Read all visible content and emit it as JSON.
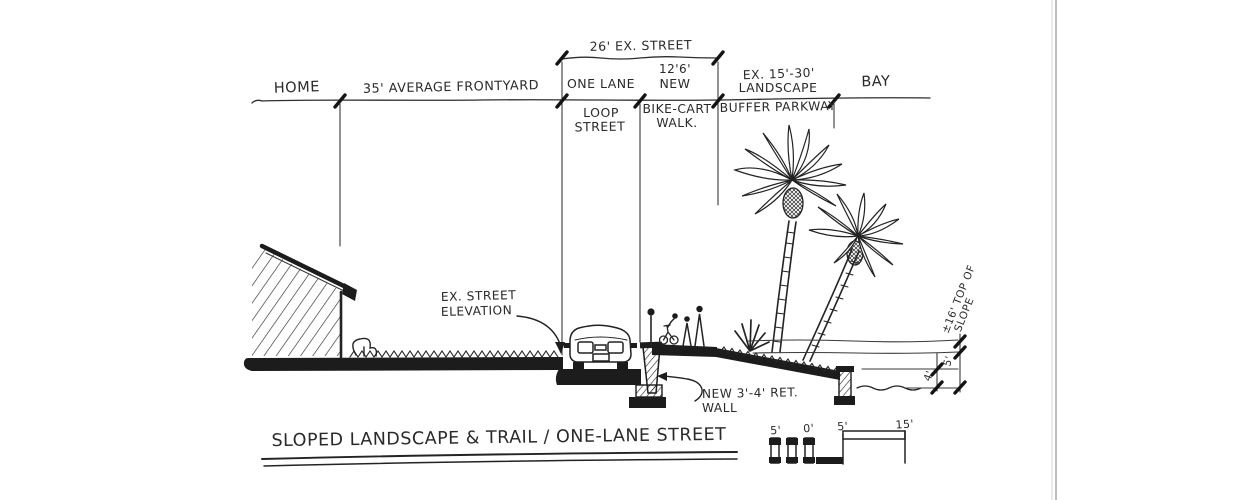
{
  "ink": "#262626",
  "paper": "#ffffff",
  "title": "SLOPED LANDSCAPE & TRAIL / ONE-LANE STREET",
  "dim": {
    "home": "HOME",
    "frontyard": "35' AVERAGE FRONTYARD",
    "ex_street": "26' EX. STREET",
    "one_lane": "ONE LANE",
    "loop": "LOOP",
    "street": "STREET",
    "new_width": "12'6'",
    "new_word": "NEW",
    "bike_cart": "BIKE-CART",
    "walk": "WALK.",
    "ex_range": "EX. 15'-30'",
    "landscape": "LANDSCAPE",
    "buffer": "BUFFER PARKWAY",
    "bay": "BAY"
  },
  "notes": {
    "elev1": "EX. STREET",
    "elev2": "ELEVATION",
    "wall1": "NEW 3'-4' RET.",
    "wall2": "WALL",
    "slope1": "±16' TOP OF",
    "slope2": "SLOPE",
    "d5": "5'",
    "d4": "4'"
  },
  "scale": {
    "s5a": "5'",
    "s0": "0'",
    "s5b": "5'",
    "s15": "15'"
  }
}
